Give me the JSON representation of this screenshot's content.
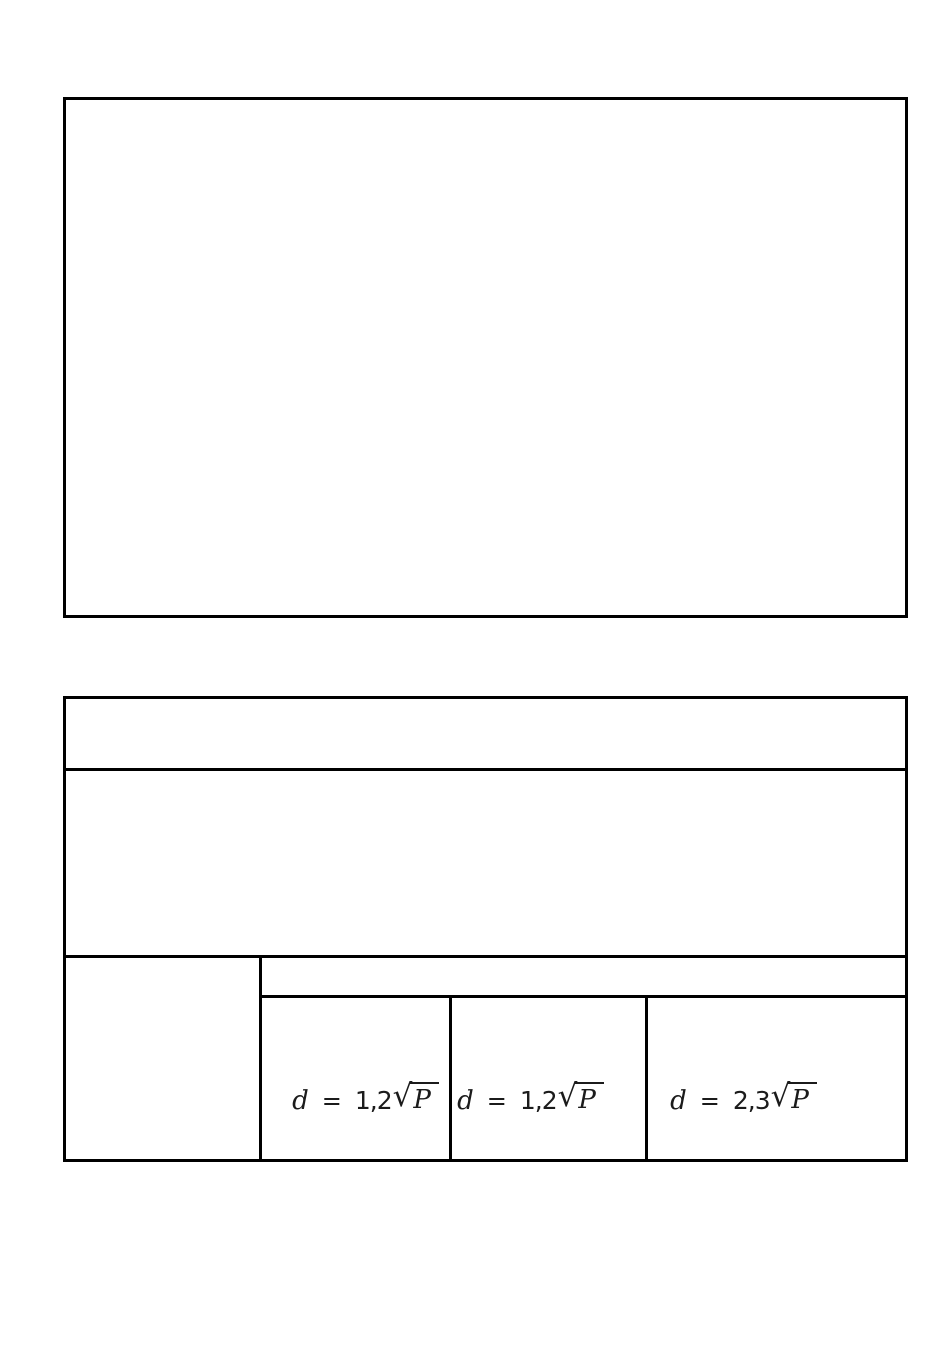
{
  "colors": {
    "background": "#ffffff",
    "border": "#000000",
    "text": "#1b1b1b"
  },
  "figure_frame": {
    "content": ""
  },
  "table": {
    "header_row": {
      "content": ""
    },
    "body_row": {
      "content": ""
    },
    "footer": {
      "left_cell": {
        "content": ""
      },
      "right_header": {
        "content": ""
      },
      "formulas": [
        {
          "variable": "d",
          "equals": "=",
          "coefficient": "1,2",
          "sqrt_of": "P",
          "text": "d = 1,2√P"
        },
        {
          "variable": "d",
          "equals": "=",
          "coefficient": "1,2",
          "sqrt_of": "P",
          "text": "d = 1,2√P"
        },
        {
          "variable": "d",
          "equals": "=",
          "coefficient": "2,3",
          "sqrt_of": "P",
          "text": "d = 2,3√P"
        }
      ],
      "sqrt_symbol": "√"
    }
  }
}
